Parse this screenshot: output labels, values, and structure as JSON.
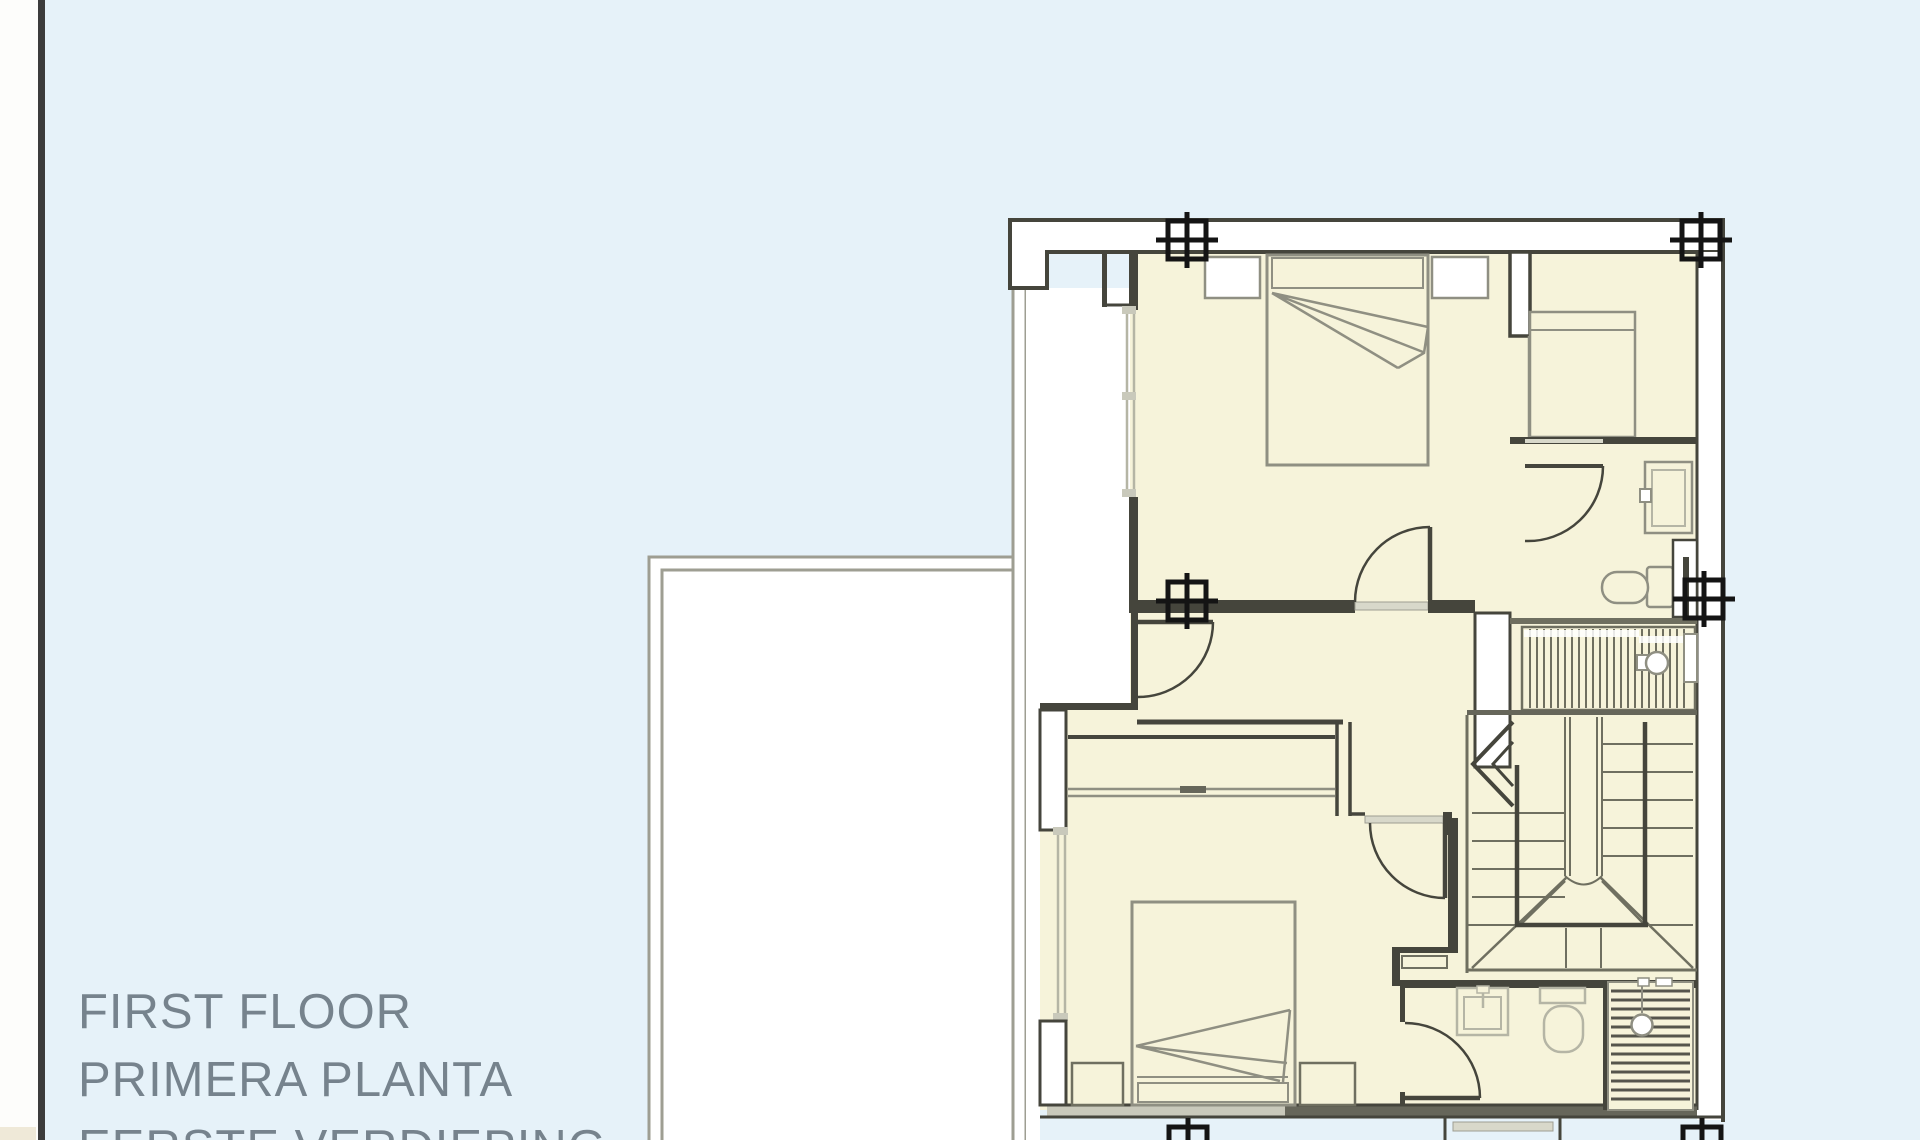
{
  "title_block": {
    "line1": "FIRST FLOOR",
    "line2": "PRIMERA PLANTA",
    "line3": "EERSTE VERDIEPING"
  },
  "colors": {
    "background": "#e6f2f9",
    "paper_white": "#ffffff",
    "room_fill": "#f6f3da",
    "wall_dark": "#45453c",
    "mid_gray": "#8f8f82",
    "soft_gray": "#6f6f60",
    "light_gray": "#b5b5a5",
    "window_fill": "#c9c9bb",
    "sill_fill": "#d8d8ca",
    "dark_band": "#66665a",
    "terrace_line": "#9e9e92",
    "page_edge": "#3c3c3c",
    "corner_paper": "#efe9d8",
    "text_gray": "#76838d",
    "mark_black": "#141414"
  },
  "plan_elements": {
    "beds": [
      "double-bed-top",
      "single-bed-right",
      "double-bed-master"
    ],
    "fixtures": [
      "shower-top",
      "toilet-top",
      "toilet-bottom",
      "washbasin-bottom",
      "shower-grate-bottom",
      "boiler-symbol"
    ],
    "circulation": [
      "switchback-staircase",
      "upper-stair-flight",
      "five-door-swings"
    ],
    "outdoor": [
      "terrace-void-left",
      "registration-marks-x6"
    ]
  }
}
